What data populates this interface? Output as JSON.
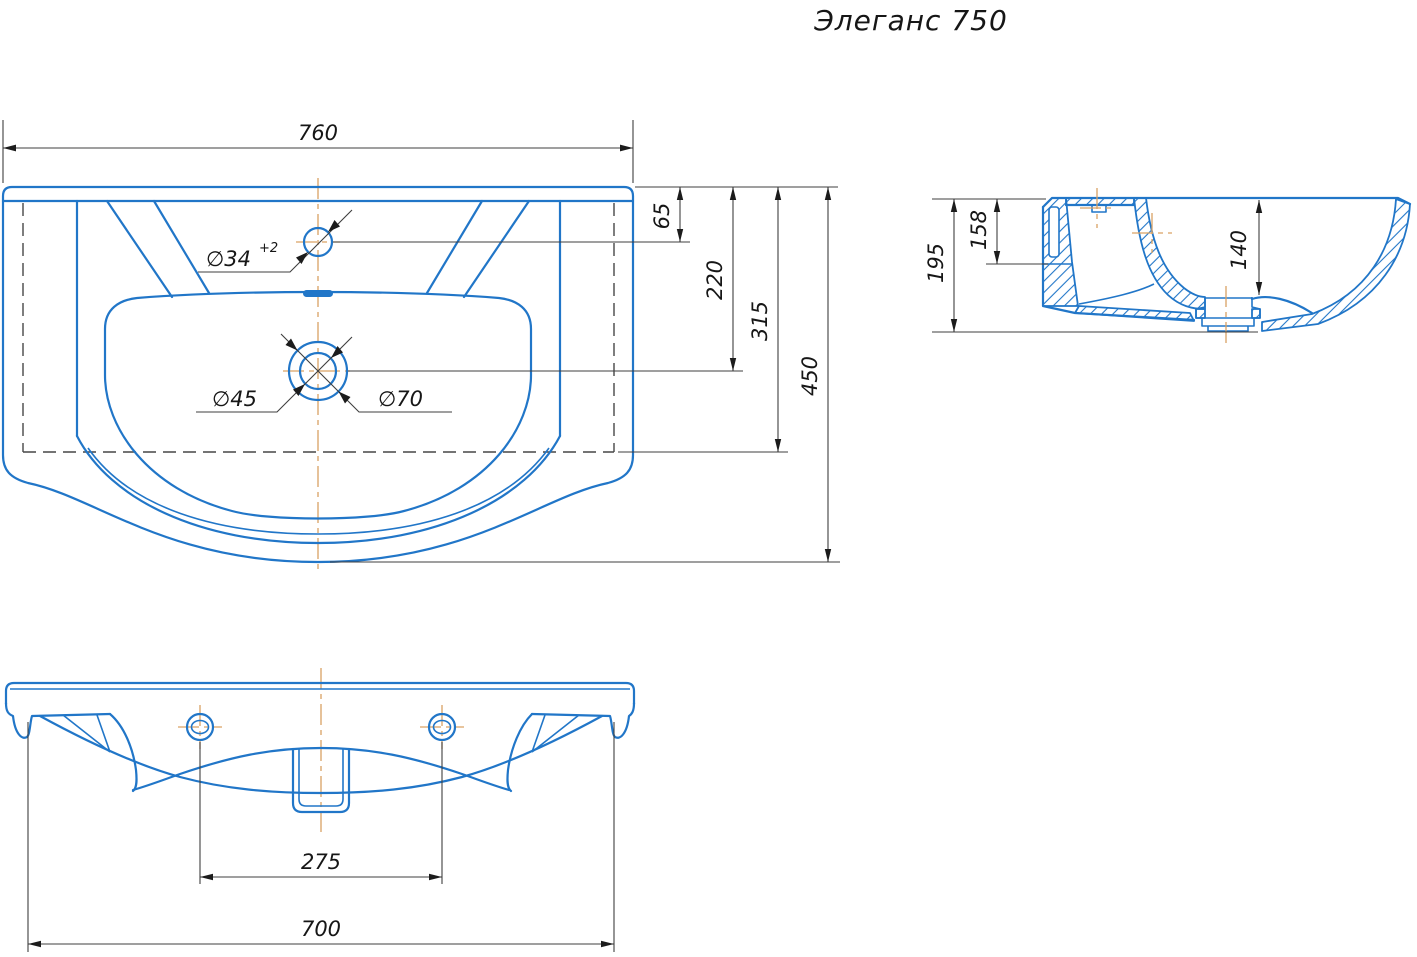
{
  "title": "Элеганс 750",
  "colors": {
    "line_blue": "#2176c8",
    "dim_line": "#3f3f3f",
    "centerline": "#d9a263",
    "text": "#161616",
    "background": "#ffffff"
  },
  "views": {
    "top_view": {
      "dims": {
        "overall_width": "760",
        "faucet_hole_offset": "65",
        "drain_offset": "220",
        "body_depth": "315",
        "overall_depth": "450",
        "faucet_hole_dia": "∅34",
        "faucet_hole_tol": "+2",
        "drain_dia": "∅45",
        "drain_recess_dia": "∅70"
      }
    },
    "side_view": {
      "dims": {
        "overall_height": "195",
        "back_height": "158",
        "bowl_depth": "140"
      }
    },
    "front_view": {
      "dims": {
        "hole_spacing": "275",
        "bottom_width": "700"
      }
    }
  }
}
